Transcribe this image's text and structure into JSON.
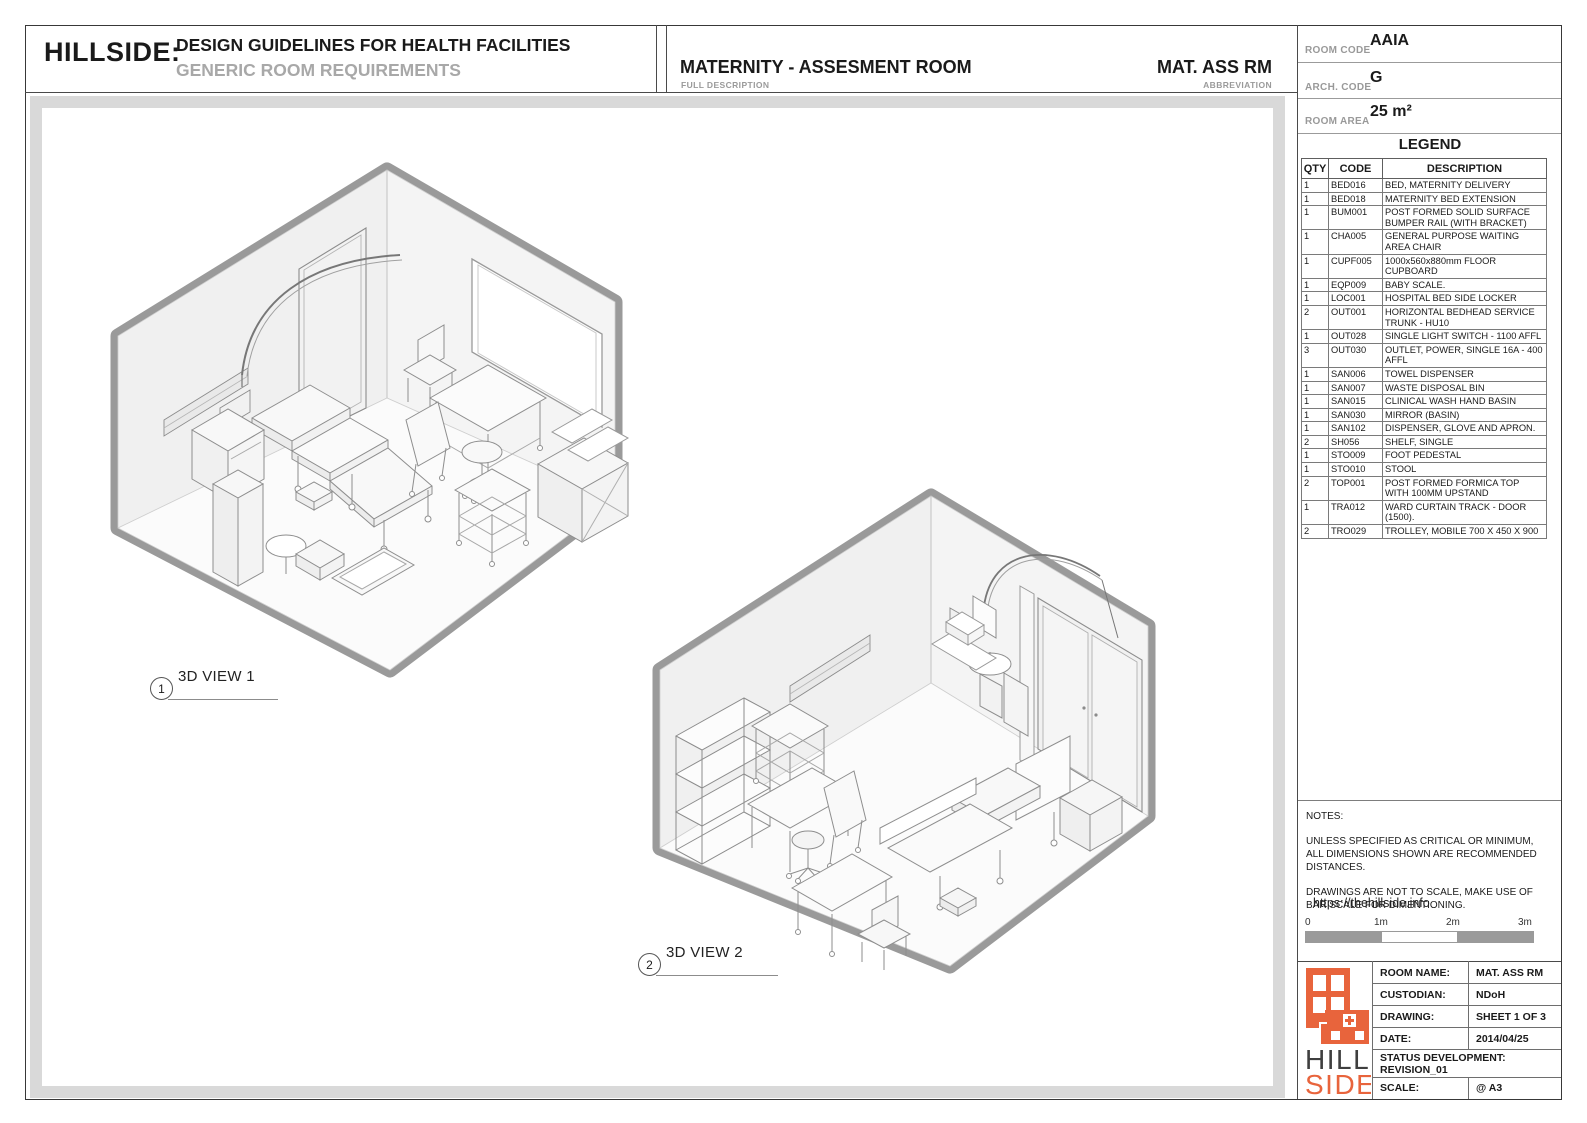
{
  "header": {
    "brand": "HILLSIDE:",
    "title": "DESIGN GUIDELINES FOR HEALTH FACILITIES",
    "subtitle": "GENERIC ROOM REQUIREMENTS",
    "room_title": "MATERNITY - ASSESMENT ROOM",
    "room_title_label": "FULL DESCRIPTION",
    "abbreviation": "MAT. ASS RM",
    "abbreviation_label": "ABBREVIATION"
  },
  "info_panel": {
    "room_code_label": "ROOM CODE",
    "room_code": "AAIA",
    "arch_code_label": "ARCH. CODE",
    "arch_code": "G",
    "room_area_label": "ROOM AREA",
    "room_area": "25 m²"
  },
  "legend": {
    "title": "LEGEND",
    "headers": [
      "QTY",
      "CODE",
      "DESCRIPTION"
    ],
    "rows": [
      [
        "1",
        "BED016",
        "BED, MATERNITY DELIVERY"
      ],
      [
        "1",
        "BED018",
        "MATERNITY BED EXTENSION"
      ],
      [
        "1",
        "BUM001",
        "POST FORMED SOLID SURFACE BUMPER RAIL (WITH BRACKET)"
      ],
      [
        "1",
        "CHA005",
        "GENERAL PURPOSE WAITING AREA CHAIR"
      ],
      [
        "1",
        "CUPF005",
        "1000x560x880mm FLOOR CUPBOARD"
      ],
      [
        "1",
        "EQP009",
        "BABY SCALE."
      ],
      [
        "1",
        "LOC001",
        "HOSPITAL BED SIDE LOCKER"
      ],
      [
        "2",
        "OUT001",
        "HORIZONTAL BEDHEAD SERVICE TRUNK - HU10"
      ],
      [
        "1",
        "OUT028",
        "SINGLE LIGHT SWITCH - 1100 AFFL"
      ],
      [
        "3",
        "OUT030",
        "OUTLET, POWER, SINGLE 16A - 400 AFFL"
      ],
      [
        "1",
        "SAN006",
        "TOWEL DISPENSER"
      ],
      [
        "1",
        "SAN007",
        "WASTE DISPOSAL BIN"
      ],
      [
        "1",
        "SAN015",
        "CLINICAL WASH HAND BASIN"
      ],
      [
        "1",
        "SAN030",
        "MIRROR (BASIN)"
      ],
      [
        "1",
        "SAN102",
        "DISPENSER, GLOVE AND APRON."
      ],
      [
        "2",
        "SH056",
        "SHELF, SINGLE"
      ],
      [
        "1",
        "STO009",
        "FOOT PEDESTAL"
      ],
      [
        "1",
        "STO010",
        "STOOL"
      ],
      [
        "2",
        "TOP001",
        "POST FORMED FORMICA TOP WITH 100MM UPSTAND"
      ],
      [
        "1",
        "TRA012",
        "WARD CURTAIN TRACK - DOOR (1500)."
      ],
      [
        "2",
        "TRO029",
        "TROLLEY, MOBILE 700 X 450 X 900"
      ]
    ]
  },
  "views": [
    {
      "number": "1",
      "label": "3D VIEW 1"
    },
    {
      "number": "2",
      "label": "3D VIEW 2"
    }
  ],
  "notes": {
    "title": "NOTES:",
    "para1": "UNLESS SPECIFIED AS CRITICAL OR MINIMUM, ALL DIMENSIONS SHOWN ARE RECOMMENDED DISTANCES.",
    "para2": "DRAWINGS ARE NOT TO SCALE, MAKE USE OF BAR SCALE FOR DIMENTIONING.",
    "link": "https://thehillside.info"
  },
  "scale_bar": {
    "ticks": [
      "0",
      "1m",
      "2m",
      "3m"
    ]
  },
  "title_block": {
    "rows": [
      {
        "label": "ROOM NAME:",
        "value": "MAT. ASS RM"
      },
      {
        "label": "CUSTODIAN:",
        "value": "NDoH"
      },
      {
        "label": "DRAWING:",
        "value": "SHEET 1 OF 3"
      },
      {
        "label": "DATE:",
        "value": "2014/04/25"
      }
    ],
    "status_label": "STATUS DEVELOPMENT:",
    "status_value": "REVISION_01",
    "scale_label": "SCALE:",
    "scale_value": "@ A3"
  },
  "logo": {
    "line1": "HILL",
    "line2": "SIDE"
  },
  "colors": {
    "accent_orange": "#E8643C",
    "wall_gray": "#9A9A9A",
    "frame_gray": "#D9D9D9",
    "subtitle_gray": "#A8A8A8"
  }
}
